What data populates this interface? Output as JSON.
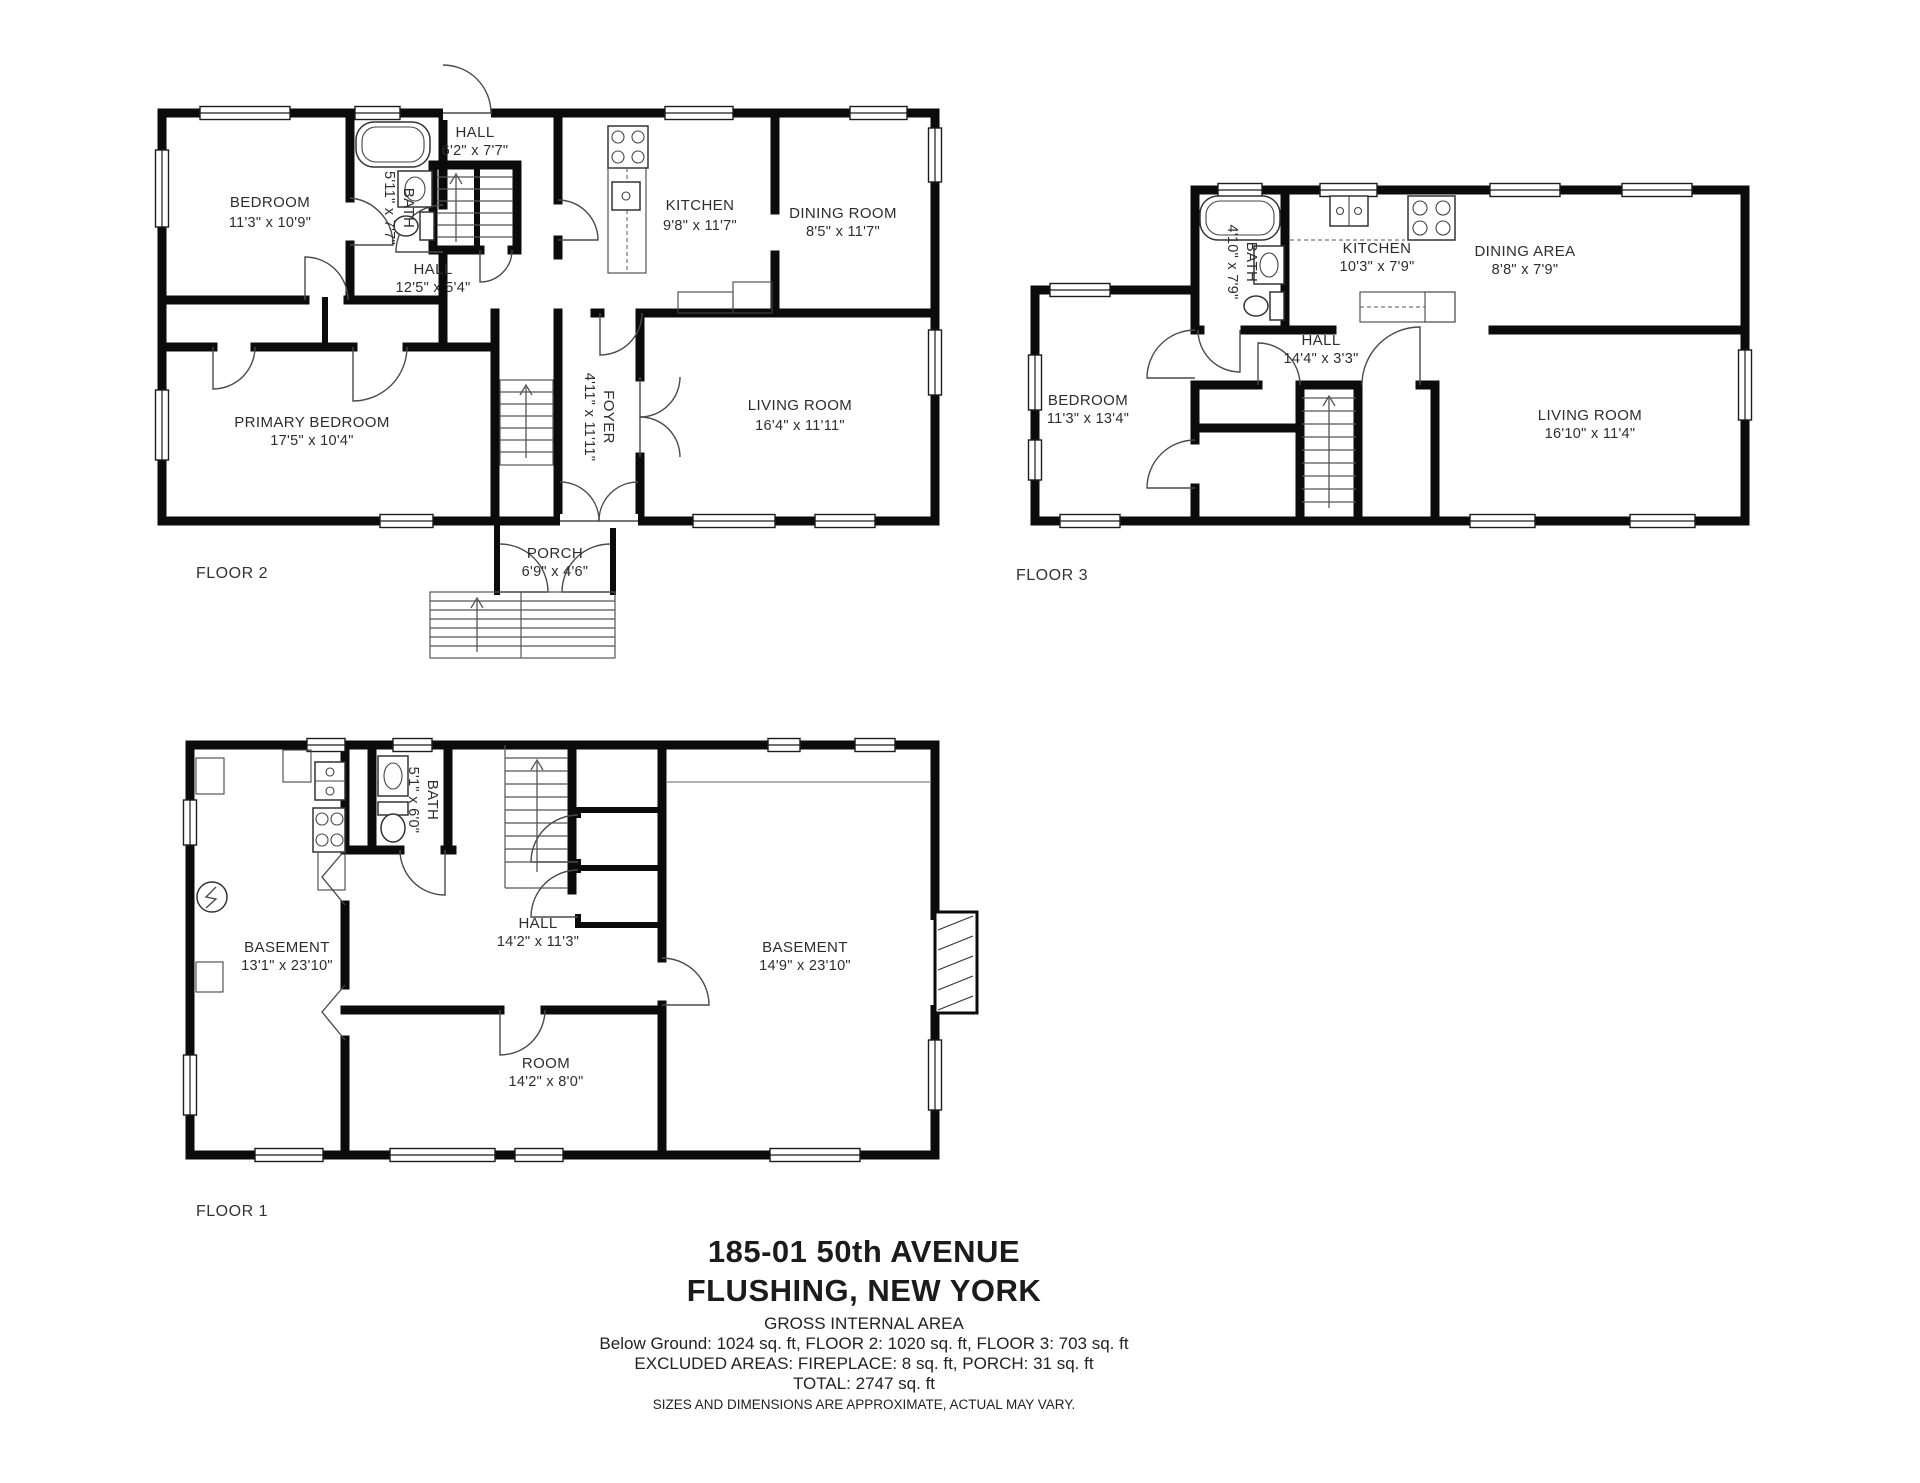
{
  "title": {
    "line1": "185-01 50th AVENUE",
    "line2": "FLUSHING, NEW YORK"
  },
  "summary": {
    "heading": "GROSS INTERNAL AREA",
    "areas": "Below Ground: 1024 sq. ft, FLOOR 2: 1020 sq. ft, FLOOR 3: 703 sq. ft",
    "excluded": "EXCLUDED AREAS: FIREPLACE: 8 sq. ft, PORCH: 31 sq. ft",
    "total": "TOTAL: 2747 sq. ft",
    "disclaimer": "SIZES AND DIMENSIONS ARE APPROXIMATE, ACTUAL MAY VARY."
  },
  "floors": {
    "floor2": {
      "label": "FLOOR 2",
      "rooms": {
        "bedroom": {
          "name": "BEDROOM",
          "dims": "11'3\" x 10'9\""
        },
        "bath": {
          "name": "BATH",
          "dims": "5'11\" x 7'7\""
        },
        "hall_upper": {
          "name": "HALL",
          "dims": "6'2\" x 7'7\""
        },
        "kitchen": {
          "name": "KITCHEN",
          "dims": "9'8\" x 11'7\""
        },
        "dining_room": {
          "name": "DINING ROOM",
          "dims": "8'5\" x 11'7\""
        },
        "hall": {
          "name": "HALL",
          "dims": "12'5\" x 5'4\""
        },
        "primary_bedroom": {
          "name": "PRIMARY BEDROOM",
          "dims": "17'5\" x 10'4\""
        },
        "foyer": {
          "name": "FOYER",
          "dims": "4'11\" x 11'11\""
        },
        "living_room": {
          "name": "LIVING ROOM",
          "dims": "16'4\" x 11'11\""
        },
        "porch": {
          "name": "PORCH",
          "dims": "6'9\" x 4'6\""
        }
      }
    },
    "floor3": {
      "label": "FLOOR 3",
      "rooms": {
        "bath": {
          "name": "BATH",
          "dims": "4'10\" x 7'9\""
        },
        "kitchen": {
          "name": "KITCHEN",
          "dims": "10'3\" x 7'9\""
        },
        "dining_area": {
          "name": "DINING AREA",
          "dims": "8'8\" x 7'9\""
        },
        "hall": {
          "name": "HALL",
          "dims": "14'4\" x 3'3\""
        },
        "bedroom": {
          "name": "BEDROOM",
          "dims": "11'3\" x 13'4\""
        },
        "living_room": {
          "name": "LIVING ROOM",
          "dims": "16'10\" x 11'4\""
        }
      }
    },
    "floor1": {
      "label": "FLOOR 1",
      "rooms": {
        "basement_left": {
          "name": "BASEMENT",
          "dims": "13'1\" x 23'10\""
        },
        "bath": {
          "name": "BATH",
          "dims": "5'1\" x 6'0\""
        },
        "hall": {
          "name": "HALL",
          "dims": "14'2\" x 11'3\""
        },
        "room": {
          "name": "ROOM",
          "dims": "14'2\" x 8'0\""
        },
        "basement_right": {
          "name": "BASEMENT",
          "dims": "14'9\" x 23'10\""
        }
      }
    }
  }
}
